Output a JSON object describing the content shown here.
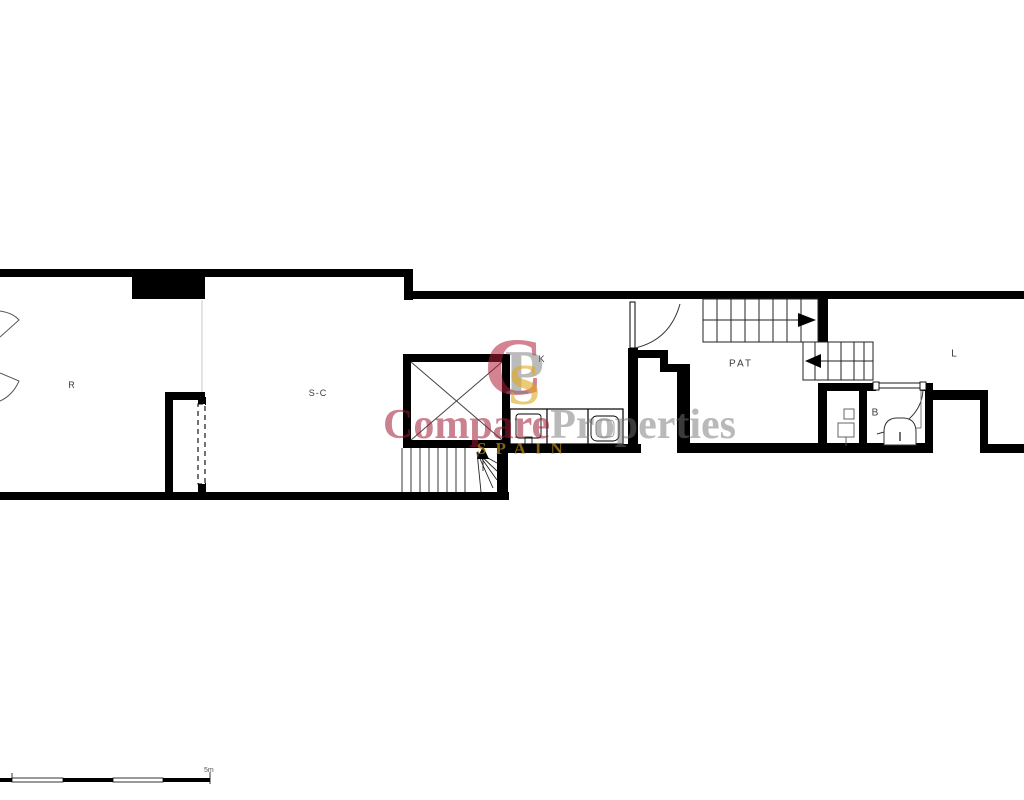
{
  "plan": {
    "rooms": {
      "r": "R",
      "sc": "S-C",
      "k": "K",
      "pat": "PAT",
      "b": "B",
      "l": "L"
    },
    "scale": {
      "label": "5m"
    }
  },
  "watermark": {
    "logo": {
      "c": "C",
      "p": "P",
      "s": "S"
    },
    "title_left": "Compare",
    "title_right": "Properties",
    "subtitle": "SPAIN",
    "colors": {
      "crimson": "#a01c34",
      "gray": "#737373",
      "gold": "#d6a018"
    }
  }
}
